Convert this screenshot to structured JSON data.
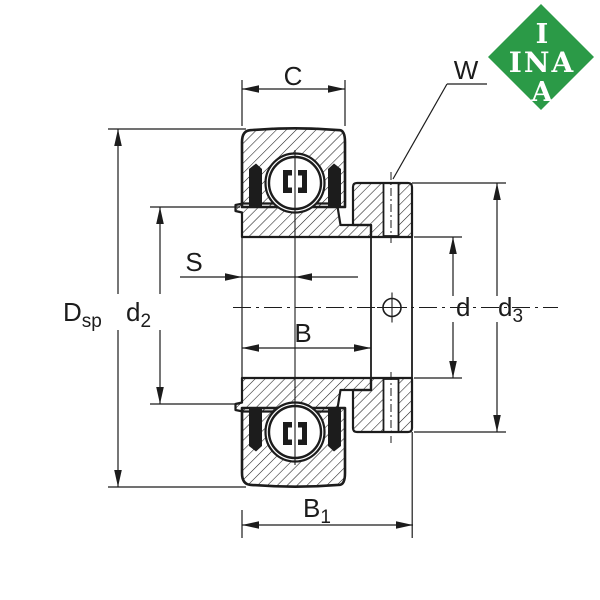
{
  "logo": {
    "line1": "I",
    "line2": "INA",
    "line3": "A"
  },
  "dim_labels": {
    "C": "C",
    "W": "W",
    "S": "S",
    "B": "B",
    "B1": {
      "base": "B",
      "sub": "1"
    },
    "Dsp": {
      "base": "D",
      "sub": "sp"
    },
    "d2": {
      "base": "d",
      "sub": "2"
    },
    "d": "d",
    "d3": {
      "base": "d",
      "sub": "3"
    }
  },
  "colors": {
    "ink": "#1c1c1c",
    "logo_green": "#2b9a47",
    "logo_text": "#ffffff",
    "background": "#ffffff"
  }
}
